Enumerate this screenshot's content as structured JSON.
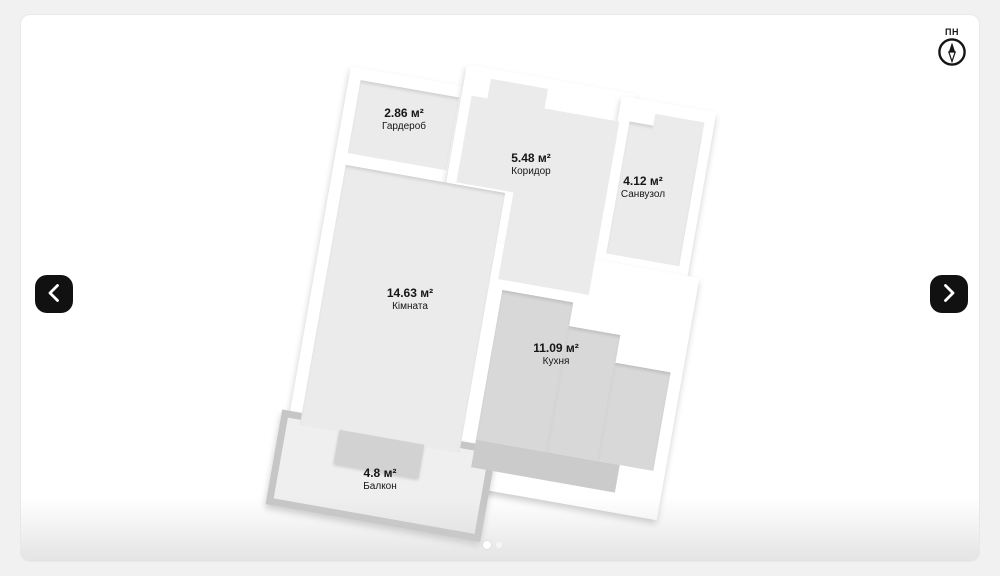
{
  "compass": {
    "north_label": "ПН",
    "icon": "compass-north-needle"
  },
  "nav": {
    "prev_icon": "chevron-left",
    "next_icon": "chevron-right"
  },
  "rooms": [
    {
      "id": "wardrobe",
      "area": "2.86 м²",
      "name": "Гардероб"
    },
    {
      "id": "corridor",
      "area": "5.48 м²",
      "name": "Коридор"
    },
    {
      "id": "bathroom",
      "area": "4.12 м²",
      "name": "Санвузол"
    },
    {
      "id": "living",
      "area": "14.63 м²",
      "name": "Кімната"
    },
    {
      "id": "kitchen",
      "area": "11.09 м²",
      "name": "Кухня"
    },
    {
      "id": "balcony",
      "area": "4.8 м²",
      "name": "Балкон"
    }
  ],
  "carousel": {
    "total_dots": 2,
    "active_dot_index": 0
  },
  "colors": {
    "page_bg": "#f1f1f1",
    "card_bg": "#ffffff",
    "room_fill": "#ebebeb",
    "kitchen_fill": "#d8d8d8",
    "kitchen_window_band": "#cbcbcb",
    "balcony_border": "#c6c6c6",
    "balcony_fill": "#efefef",
    "nav_button_bg": "#111111",
    "text": "#161616"
  }
}
